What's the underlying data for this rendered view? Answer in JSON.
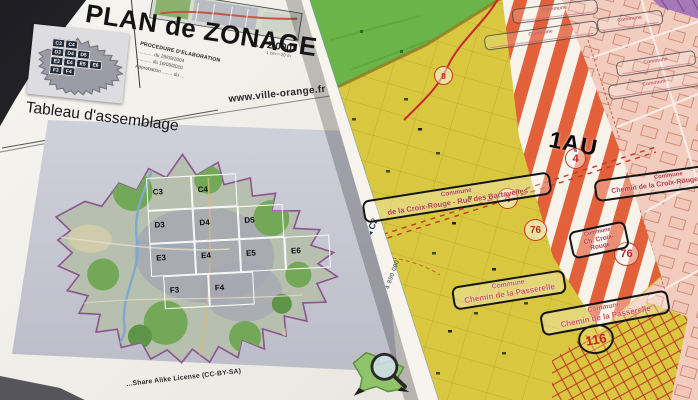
{
  "title_block": {
    "title": "PLAN de ZONAGE",
    "scale": "1 / 2 000",
    "scale_note": "1 cm = 20 m",
    "procedure_heading": "PROCEDURE D'ELABORATION",
    "procedure_lines": [
      "........... du 29/09/2004",
      "........... du 16/09/2010",
      "Approbation ........ du ..."
    ],
    "website": "www.ville-orange.fr"
  },
  "assemblage": {
    "heading": "Tableau d'assemblage",
    "license": "...Share Alike License (CC-BY-SA)",
    "tiles": [
      "C3",
      "C4",
      "D3",
      "D4",
      "D5",
      "E3",
      "E4",
      "E5",
      "E6",
      "F3",
      "F4"
    ]
  },
  "zoning_map": {
    "sheet_ref": "C2",
    "edge_arrow": "◄",
    "grid_coordinate": "4 890 000",
    "zone_code": "1AU",
    "markers": [
      {
        "value": "8"
      },
      {
        "value": "4"
      },
      {
        "value": "4"
      },
      {
        "value": "76"
      },
      {
        "value": "76"
      },
      {
        "value": "116"
      }
    ],
    "commune_labels": [
      {
        "line1": "Commune",
        "line2": "de la Croix-Rouge - Rue des Bartavelles"
      },
      {
        "line1": "Commune",
        "line2": "Chemin de la Croix-Rouge : Rue de"
      },
      {
        "line1": "Commune",
        "line2": "Ch. Croix-Rouge"
      },
      {
        "line1": "Commune",
        "line2": "Chemin de la Passerelle"
      },
      {
        "line1": "Commune",
        "line2": "Chemin de la Passerelle"
      }
    ],
    "faint_labels": [
      "Commune",
      "Commune",
      "Commune",
      "Commune",
      "Commune"
    ],
    "colors": {
      "zone_stripe": "#e2603a",
      "zone_yellow": "#d8c73f",
      "zone_green": "#6ab449",
      "zone_pink": "#f2cdbf",
      "boundary_purple": "#a678b8",
      "marker_red": "#c23a28"
    }
  }
}
